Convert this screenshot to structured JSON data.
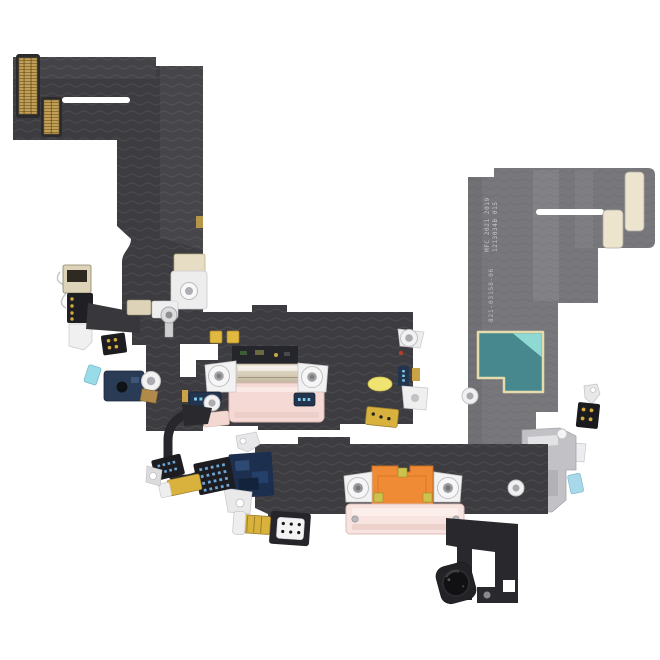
{
  "meta": {
    "description": "Product photo of an iPhone charging-port flex cable assembly (pink) shown from front and back on a plain white background",
    "background": "#ffffff"
  },
  "markings": {
    "stamp_line1": "MFC 2021 2019",
    "stamp_line2": "1213034B 015",
    "part_number": "821-03158-06"
  },
  "colors": {
    "flex_dark": "#3d3d41",
    "flex_back_gray": "#78787c",
    "port_pink": "#f4d9d5",
    "port_pink_back": "#f7e4e0",
    "bracket_metal_light": "#ece5d6",
    "bracket_metal_dark": "#b1a489",
    "kapton_orange": "#ef8a35",
    "emi_shield_teal": "#47888e",
    "emi_shield_teal_light": "#8fd9d4",
    "emi_border_cream": "#e5dcae",
    "connector_gold": "#c49e57",
    "contact_gold": "#e2b93f",
    "mic_gold": "#d8b23c",
    "pad_cream": "#ece4cc",
    "metal_white": "#f2f2f3",
    "metal_gray": "#c2c2c6",
    "component_navy": "#23344e",
    "connector_dot_blue": "#7ecbe8",
    "branch_dot_blue": "#6aa6d8",
    "patch_navy": "#1c2f4e",
    "tab_cyan": "#9adbe8"
  }
}
